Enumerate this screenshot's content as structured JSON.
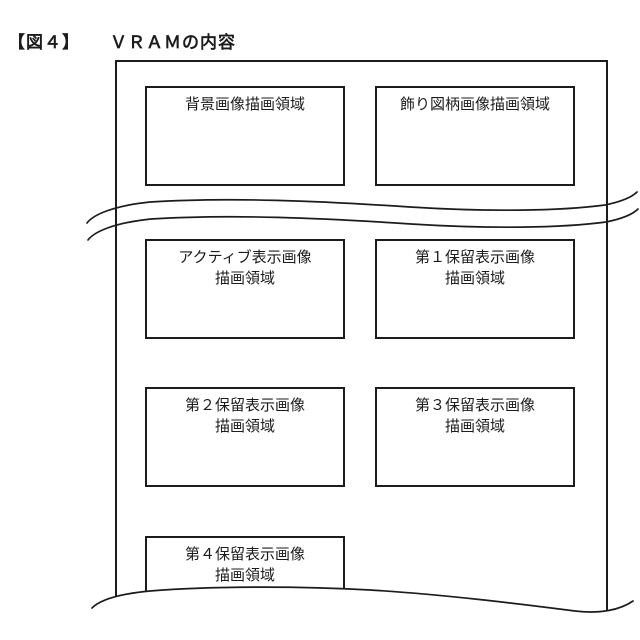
{
  "figure": {
    "label": "【図４】",
    "title": "ＶＲＡＭの内容"
  },
  "vram": {
    "regions": [
      {
        "line1": "背景画像描画領域"
      },
      {
        "line1": "飾り図柄画像描画領域"
      },
      {
        "line1": "アクティブ表示画像",
        "line2": "描画領域"
      },
      {
        "line1": "第１保留表示画像",
        "line2": "描画領域"
      },
      {
        "line1": "第２保留表示画像",
        "line2": "描画領域"
      },
      {
        "line1": "第３保留表示画像",
        "line2": "描画領域"
      },
      {
        "line1": "第４保留表示画像",
        "line2": "描画領域"
      }
    ]
  },
  "colors": {
    "line": "#1c1c1c",
    "background": "#ffffff"
  }
}
